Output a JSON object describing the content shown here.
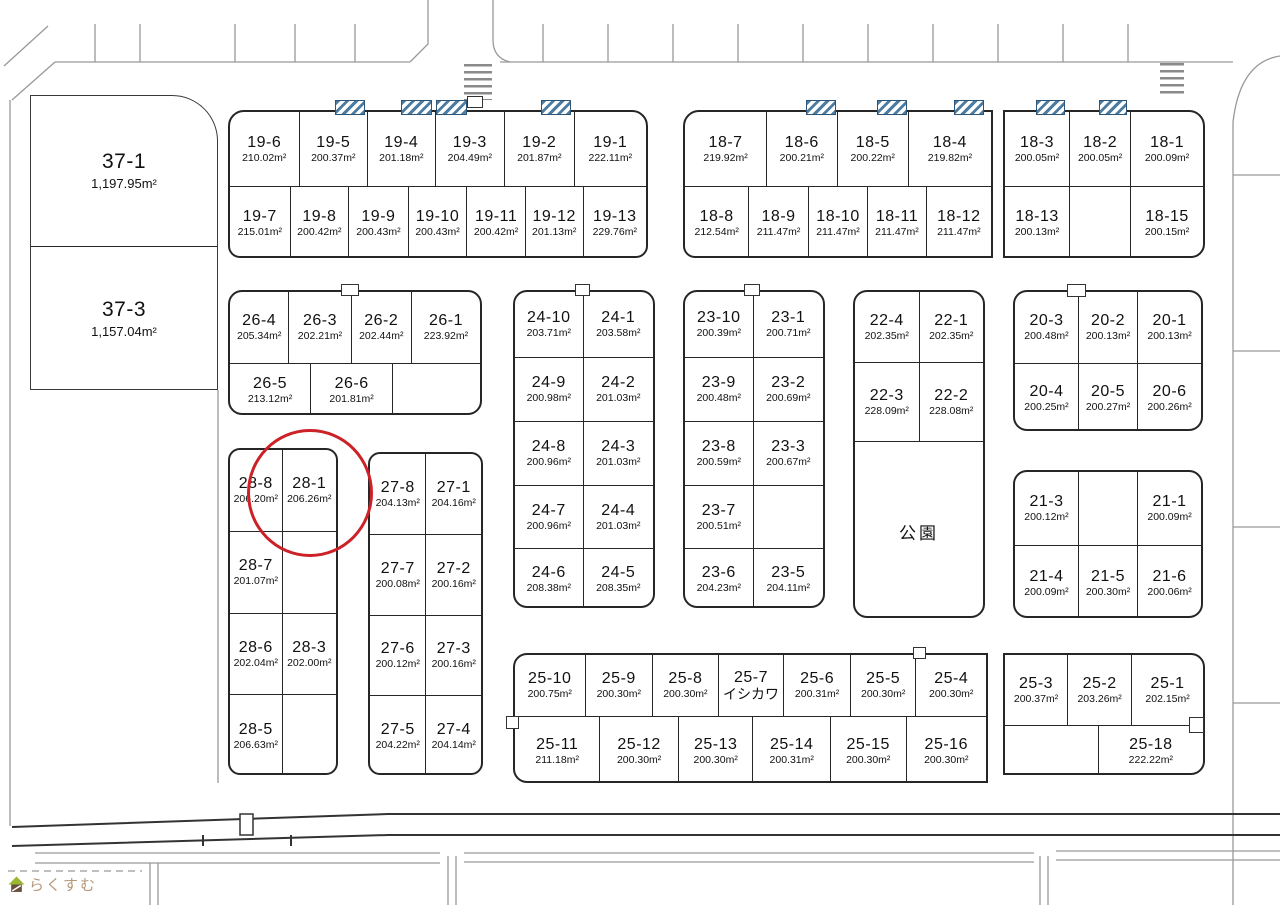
{
  "watermark": {
    "text": "らくすむ"
  },
  "annotations": {
    "selected_lot": "28-1",
    "note": "red circle around lot 28-1"
  },
  "colors": {
    "circle_red": "#cc2127",
    "hatch_blue": "#4d7ca3",
    "line_dark": "#262626",
    "watermark_text": "#b5987a",
    "watermark_roof_green": "#9ab832"
  },
  "blocks": {
    "b37": {
      "rows": [
        [
          {
            "id": "37-1",
            "sub": "1,197.95m²"
          }
        ],
        [
          {
            "id": "37-3",
            "sub": "1,157.04m²"
          }
        ]
      ]
    },
    "b19": {
      "rows": [
        [
          {
            "id": "19-6",
            "sub": "210.02m²"
          },
          {
            "id": "19-5",
            "sub": "200.37m²"
          },
          {
            "id": "19-4",
            "sub": "201.18m²"
          },
          {
            "id": "19-3",
            "sub": "204.49m²"
          },
          {
            "id": "19-2",
            "sub": "201.87m²"
          },
          {
            "id": "19-1",
            "sub": "222.11m²"
          }
        ],
        [
          {
            "id": "19-7",
            "sub": "215.01m²"
          },
          {
            "id": "19-8",
            "sub": "200.42m²"
          },
          {
            "id": "19-9",
            "sub": "200.43m²"
          },
          {
            "id": "19-10",
            "sub": "200.43m²"
          },
          {
            "id": "19-11",
            "sub": "200.42m²"
          },
          {
            "id": "19-12",
            "sub": "201.13m²"
          },
          {
            "id": "19-13",
            "sub": "229.76m²"
          }
        ]
      ]
    },
    "b18w": {
      "rows": [
        [
          {
            "id": "18-7",
            "sub": "219.92m²"
          },
          {
            "id": "18-6",
            "sub": "200.21m²"
          },
          {
            "id": "18-5",
            "sub": "200.22m²"
          },
          {
            "id": "18-4",
            "sub": "219.82m²"
          }
        ],
        [
          {
            "id": "18-8",
            "sub": "212.54m²"
          },
          {
            "id": "18-9",
            "sub": "211.47m²"
          },
          {
            "id": "18-10",
            "sub": "211.47m²"
          },
          {
            "id": "18-11",
            "sub": "211.47m²"
          },
          {
            "id": "18-12",
            "sub": "211.47m²"
          }
        ]
      ]
    },
    "b18e": {
      "rows": [
        [
          {
            "id": "18-3",
            "sub": "200.05m²"
          },
          {
            "id": "18-2",
            "sub": "200.05m²"
          },
          {
            "id": "18-1",
            "sub": "200.09m²"
          }
        ],
        [
          {
            "id": "18-13",
            "sub": "200.13m²"
          },
          {},
          {
            "id": "18-15",
            "sub": "200.15m²"
          }
        ]
      ]
    },
    "b26": {
      "rows": [
        [
          {
            "id": "26-4",
            "sub": "205.34m²"
          },
          {
            "id": "26-3",
            "sub": "202.21m²"
          },
          {
            "id": "26-2",
            "sub": "202.44m²"
          },
          {
            "id": "26-1",
            "sub": "223.92m²"
          }
        ],
        [
          {
            "id": "26-5",
            "sub": "213.12m²"
          },
          {
            "id": "26-6",
            "sub": "201.81m²"
          },
          {}
        ]
      ]
    },
    "b24": {
      "rows": [
        [
          {
            "id": "24-10",
            "sub": "203.71m²"
          },
          {
            "id": "24-1",
            "sub": "203.58m²"
          }
        ],
        [
          {
            "id": "24-9",
            "sub": "200.98m²"
          },
          {
            "id": "24-2",
            "sub": "201.03m²"
          }
        ],
        [
          {
            "id": "24-8",
            "sub": "200.96m²"
          },
          {
            "id": "24-3",
            "sub": "201.03m²"
          }
        ],
        [
          {
            "id": "24-7",
            "sub": "200.96m²"
          },
          {
            "id": "24-4",
            "sub": "201.03m²"
          }
        ],
        [
          {
            "id": "24-6",
            "sub": "208.38m²"
          },
          {
            "id": "24-5",
            "sub": "208.35m²"
          }
        ]
      ]
    },
    "b23": {
      "rows": [
        [
          {
            "id": "23-10",
            "sub": "200.39m²"
          },
          {
            "id": "23-1",
            "sub": "200.71m²"
          }
        ],
        [
          {
            "id": "23-9",
            "sub": "200.48m²"
          },
          {
            "id": "23-2",
            "sub": "200.69m²"
          }
        ],
        [
          {
            "id": "23-8",
            "sub": "200.59m²"
          },
          {
            "id": "23-3",
            "sub": "200.67m²"
          }
        ],
        [
          {
            "id": "23-7",
            "sub": "200.51m²"
          },
          {}
        ],
        [
          {
            "id": "23-6",
            "sub": "204.23m²"
          },
          {
            "id": "23-5",
            "sub": "204.11m²"
          }
        ]
      ]
    },
    "b22": {
      "rows": [
        [
          {
            "id": "22-4",
            "sub": "202.35m²"
          },
          {
            "id": "22-1",
            "sub": "202.35m²"
          }
        ],
        [
          {
            "id": "22-3",
            "sub": "228.09m²"
          },
          {
            "id": "22-2",
            "sub": "228.08m²"
          }
        ],
        [
          {
            "label": "公園"
          }
        ]
      ]
    },
    "b20": {
      "rows": [
        [
          {
            "id": "20-3",
            "sub": "200.48m²"
          },
          {
            "id": "20-2",
            "sub": "200.13m²"
          },
          {
            "id": "20-1",
            "sub": "200.13m²"
          }
        ],
        [
          {
            "id": "20-4",
            "sub": "200.25m²"
          },
          {
            "id": "20-5",
            "sub": "200.27m²"
          },
          {
            "id": "20-6",
            "sub": "200.26m²"
          }
        ]
      ]
    },
    "b21": {
      "rows": [
        [
          {
            "id": "21-3",
            "sub": "200.12m²"
          },
          {},
          {
            "id": "21-1",
            "sub": "200.09m²"
          }
        ],
        [
          {
            "id": "21-4",
            "sub": "200.09m²"
          },
          {
            "id": "21-5",
            "sub": "200.30m²"
          },
          {
            "id": "21-6",
            "sub": "200.06m²"
          }
        ]
      ]
    },
    "b28": {
      "rows": [
        [
          {
            "id": "28-8",
            "sub": "206.20m²"
          },
          {
            "id": "28-1",
            "sub": "206.26m²"
          }
        ],
        [
          {
            "id": "28-7",
            "sub": "201.07m²"
          },
          {}
        ],
        [
          {
            "id": "28-6",
            "sub": "202.04m²"
          },
          {
            "id": "28-3",
            "sub": "202.00m²"
          }
        ],
        [
          {
            "id": "28-5",
            "sub": "206.63m²"
          },
          {}
        ]
      ]
    },
    "b27": {
      "rows": [
        [
          {
            "id": "27-8",
            "sub": "204.13m²"
          },
          {
            "id": "27-1",
            "sub": "204.16m²"
          }
        ],
        [
          {
            "id": "27-7",
            "sub": "200.08m²"
          },
          {
            "id": "27-2",
            "sub": "200.16m²"
          }
        ],
        [
          {
            "id": "27-6",
            "sub": "200.12m²"
          },
          {
            "id": "27-3",
            "sub": "200.16m²"
          }
        ],
        [
          {
            "id": "27-5",
            "sub": "204.22m²"
          },
          {
            "id": "27-4",
            "sub": "204.14m²"
          }
        ]
      ]
    },
    "b25": {
      "rows": [
        [
          {
            "id": "25-10",
            "sub": "200.75m²"
          },
          {
            "id": "25-9",
            "sub": "200.30m²"
          },
          {
            "id": "25-8",
            "sub": "200.30m²"
          },
          {
            "id": "25-7",
            "sub": "イシカワ"
          },
          {
            "id": "25-6",
            "sub": "200.31m²"
          },
          {
            "id": "25-5",
            "sub": "200.30m²"
          },
          {
            "id": "25-4",
            "sub": "200.30m²"
          }
        ],
        [
          {
            "id": "25-11",
            "sub": "211.18m²"
          },
          {
            "id": "25-12",
            "sub": "200.30m²"
          },
          {
            "id": "25-13",
            "sub": "200.30m²"
          },
          {
            "id": "25-14",
            "sub": "200.31m²"
          },
          {
            "id": "25-15",
            "sub": "200.30m²"
          },
          {
            "id": "25-16",
            "sub": "200.30m²"
          }
        ]
      ]
    },
    "b25e": {
      "rows": [
        [
          {
            "id": "25-3",
            "sub": "200.37m²"
          },
          {
            "id": "25-2",
            "sub": "203.26m²"
          },
          {
            "id": "25-1",
            "sub": "202.15m²"
          }
        ],
        [
          {},
          {
            "id": "25-18",
            "sub": "222.22m²"
          }
        ]
      ]
    }
  }
}
